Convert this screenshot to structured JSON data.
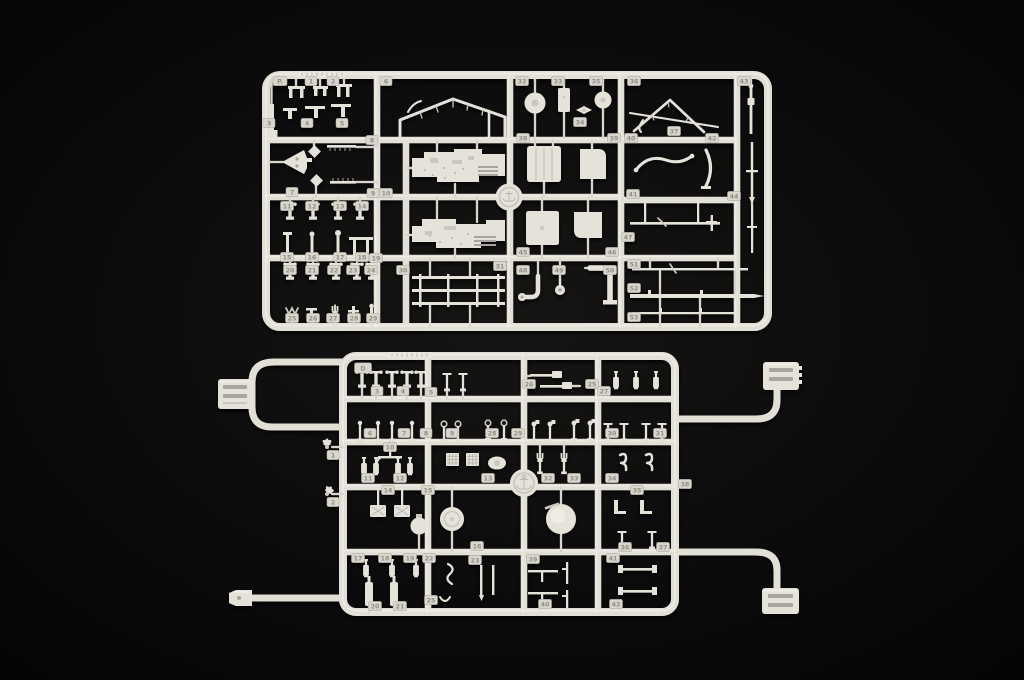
{
  "scene": {
    "description": "Photograph of two white injection-molded plastic model kit sprues (parts trees) laid on a black background",
    "background_color": "#080808",
    "plastic_color": "#e5e2da",
    "plastic_shadow": "#a9a59c",
    "plastic_highlight": "#f6f4ef",
    "tag_color": "#d9d6ce"
  },
  "top_sprue": {
    "label": "large rectangular parts sprue",
    "medallion": "circular maker emblem",
    "tags": [
      "P.",
      "1",
      "2",
      "6",
      "32",
      "33",
      "35",
      "36",
      "43",
      "3",
      "4",
      "5",
      "8",
      "34",
      "37",
      "38",
      "39",
      "40",
      "42",
      "7",
      "9",
      "10",
      "41",
      "44",
      "11",
      "12",
      "13",
      "14",
      "15",
      "16",
      "17",
      "18",
      "19",
      "47",
      "20",
      "21",
      "22",
      "23",
      "24",
      "30",
      "31",
      "45",
      "46",
      "51",
      "48",
      "49",
      "50",
      "52",
      "53",
      "25",
      "26",
      "27",
      "28",
      "29"
    ]
  },
  "bottom_sprue": {
    "label": "small parts sprue with four runner arms and corner connector clips",
    "letter_badge": "D",
    "medallion": "circular anchor emblem",
    "tags": [
      "D",
      "3",
      "4",
      "5",
      "26",
      "25",
      "27",
      "6",
      "7",
      "8",
      "9",
      "28",
      "29",
      "30",
      "31",
      "10",
      "11",
      "12",
      "13",
      "32",
      "33",
      "34",
      "38",
      "14",
      "15",
      "16",
      "35",
      "36",
      "37",
      "17",
      "18",
      "19",
      "22",
      "23",
      "20",
      "21",
      "25",
      "39",
      "40",
      "41",
      "42",
      "1",
      "2"
    ]
  }
}
